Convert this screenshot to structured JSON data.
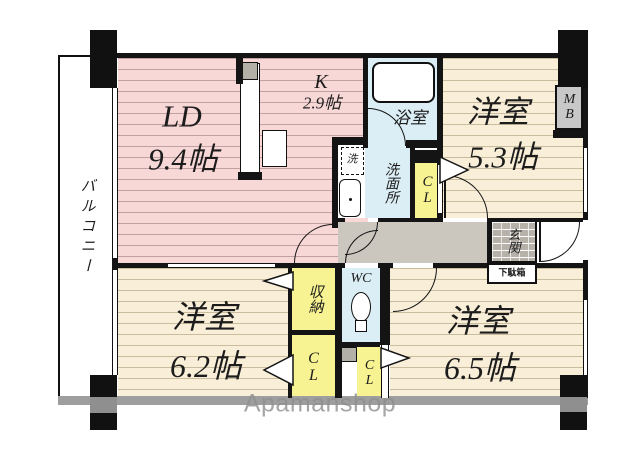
{
  "floorplan": {
    "balcony_label": "バルコニー",
    "ld": {
      "label": "LD",
      "size": "9.4帖"
    },
    "kitchen": {
      "label": "K",
      "size": "2.9帖"
    },
    "bath": {
      "label": "浴室"
    },
    "washroom": {
      "label": "洗面所"
    },
    "laundry": {
      "label": "洗"
    },
    "closet_upper": {
      "label": "CL"
    },
    "western1": {
      "label": "洋室",
      "size": "5.3帖"
    },
    "meter_box": {
      "label": "MB"
    },
    "western2": {
      "label": "洋室",
      "size": "6.2帖"
    },
    "western3": {
      "label": "洋室",
      "size": "6.5帖"
    },
    "storage": {
      "label": "収納"
    },
    "wc": {
      "label": "WC"
    },
    "closet_lower_left": {
      "label": "CL"
    },
    "closet_lower_right": {
      "label": "CL"
    },
    "entrance": {
      "label": "玄関"
    },
    "shoe_box": {
      "label": "下駄箱"
    },
    "watermark": "Apamanshop",
    "colors": {
      "room_pink": "#f8d7d7",
      "room_cream": "#f9efd9",
      "wet_blue": "#dceef5",
      "closet_yellow": "#f7f292",
      "corridor_gray": "#cbc7bf",
      "entrance_tile": "#b6b2aa",
      "wall_black": "#141414",
      "outer_gray": "#9e9e9e",
      "meter_box_gray": "#c8c8c8"
    }
  }
}
